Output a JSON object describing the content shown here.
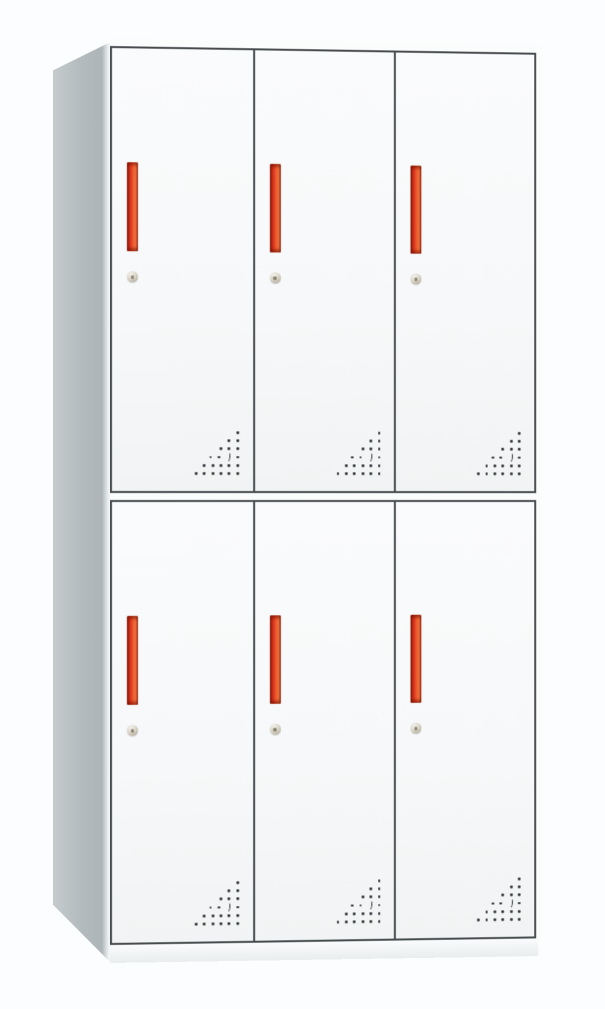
{
  "scene": {
    "type": "product-photograph",
    "subject": "white steel locker cabinet with six doors",
    "background_style": "plain white studio backdrop",
    "view": "front view, slight perspective showing left side panel"
  },
  "cabinet": {
    "rows": 2,
    "columns": 3,
    "door_count": 6,
    "door_features": [
      "vertical-red-handle",
      "round-keyhole-lock",
      "triangular-ventilation-perforation"
    ],
    "handle_orientation": "vertical",
    "vent_position": "bottom-right corner of each door",
    "handle_position": "upper-left area of each door",
    "keyhole_position": "below handle"
  },
  "perforation": {
    "pattern": "right-triangle of drilled holes",
    "rows": [
      1,
      2,
      3,
      4,
      5,
      6
    ],
    "alignment": "right-aligned, widest row at bottom",
    "crescent": {
      "row_index": 3,
      "from_right": 2
    }
  },
  "colors": {
    "background": "#fcfdfe",
    "door_face": "#f7f9fa",
    "frame_line": "#464b4e",
    "side_panel": "#b7bec1",
    "handle_red_bright": "#ee5b2e",
    "handle_red_mid": "#d5301a",
    "handle_red_dark": "#8f2011",
    "keyhole_metal": "#c9c2b2",
    "vent_hole": "#2f3436",
    "plinth": "#eef1f2"
  }
}
